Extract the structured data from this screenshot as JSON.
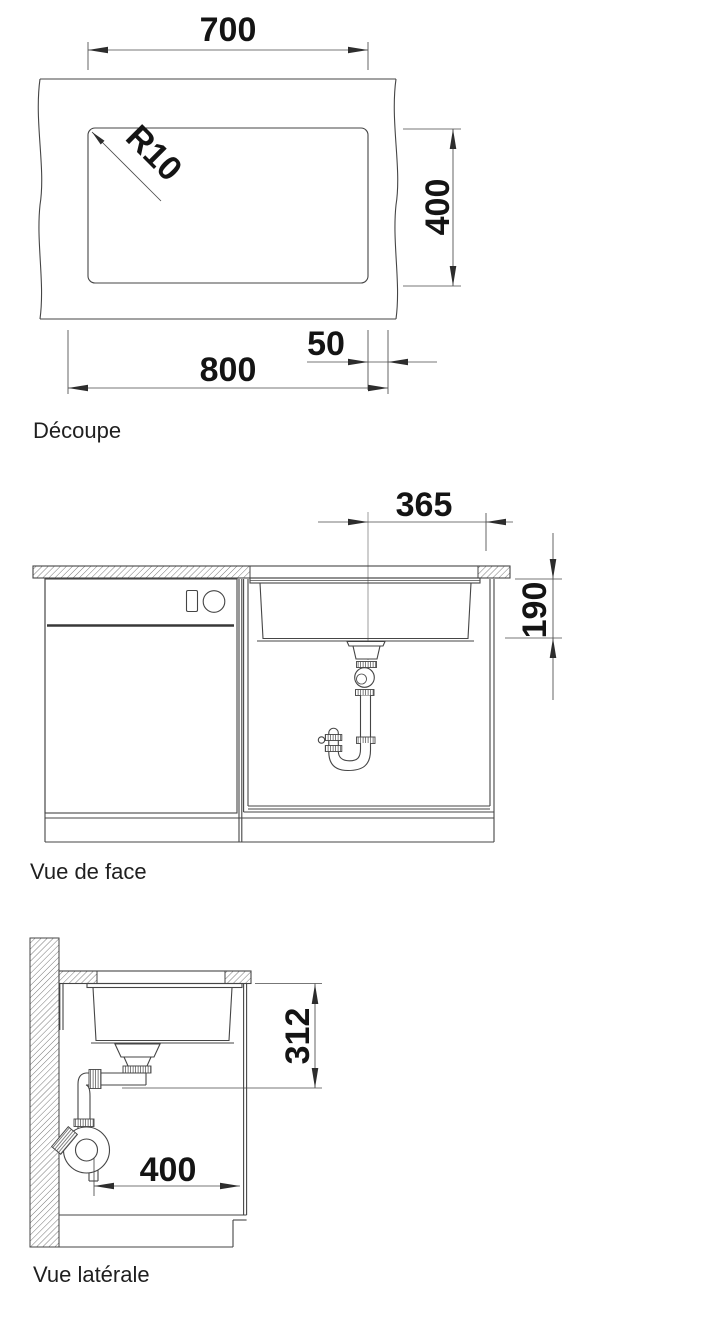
{
  "drawing": {
    "background": "#ffffff",
    "line_color": "#454545",
    "text_color": "#141414",
    "views": {
      "decoupe": {
        "label": "Découpe",
        "dims": {
          "cutout_width": "700",
          "cutout_depth": "400",
          "corner_radius": "R10",
          "side_offset": "50",
          "cabinet_width": "800"
        }
      },
      "vue_de_face": {
        "label": "Vue de face",
        "dims": {
          "drain_offset": "365",
          "bowl_depth": "190"
        }
      },
      "vue_laterale": {
        "label": "Vue latérale",
        "dims": {
          "drain_height": "312",
          "drain_distance": "400"
        }
      }
    }
  }
}
